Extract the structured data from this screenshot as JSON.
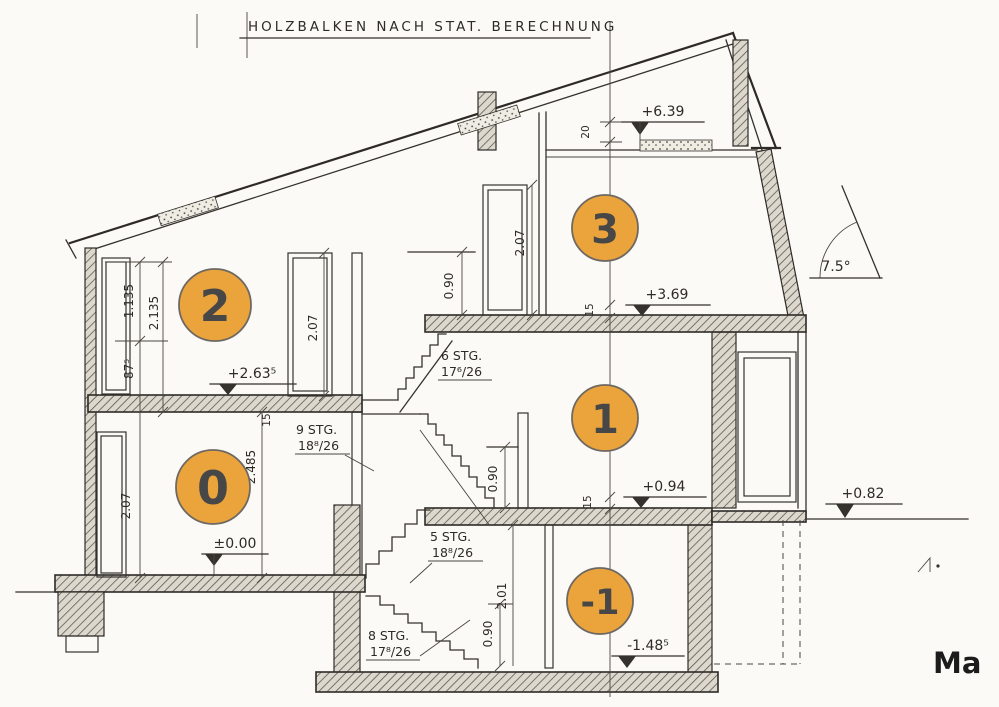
{
  "drawing": {
    "note": "HOLZBALKEN NACH STAT. BERECHNUNG",
    "corner_label": "Ma",
    "angle_label": "7.5°"
  },
  "level_badges": {
    "b0": "0",
    "b1": "1",
    "b2": "2",
    "b3": "3",
    "bm1": "-1"
  },
  "elevations": {
    "roof": "+6.39",
    "floor3": "+3.69",
    "floor2": "+2.63⁵",
    "floor1": "+0.94",
    "terrace": "+0.82",
    "floor0": "±0.00",
    "basement": "-1.48⁵"
  },
  "stairs": {
    "to3": {
      "line1": "6 STG.",
      "line2": "17⁶/26"
    },
    "to2": {
      "line1": "9 STG.",
      "line2": "18⁸/26"
    },
    "to1": {
      "line1": "5 STG.",
      "line2": "18⁸/26"
    },
    "to0": {
      "line1": "8 STG.",
      "line2": "17⁸/26"
    }
  },
  "dimensions": {
    "win_upper": "1.135",
    "win_full": "2.135",
    "parapet": "87⁵",
    "room0_height": "2.485",
    "door2_height": "2.07",
    "door0_height": "2.07",
    "door3_height": "2.07",
    "rail3_height": "0.90",
    "rail1_height": "0.90",
    "base_win_height": "0.90",
    "base_door_height": "2.01",
    "slab_20": "20",
    "slab15_a": "15",
    "slab15_b": "15",
    "slab15_c": "15"
  },
  "colors": {
    "badge_fill": "#EBA43C",
    "badge_stroke": "#6e6862",
    "badge_text": "#474747",
    "ink": "#35322d",
    "paper": "#FBFAF6"
  }
}
